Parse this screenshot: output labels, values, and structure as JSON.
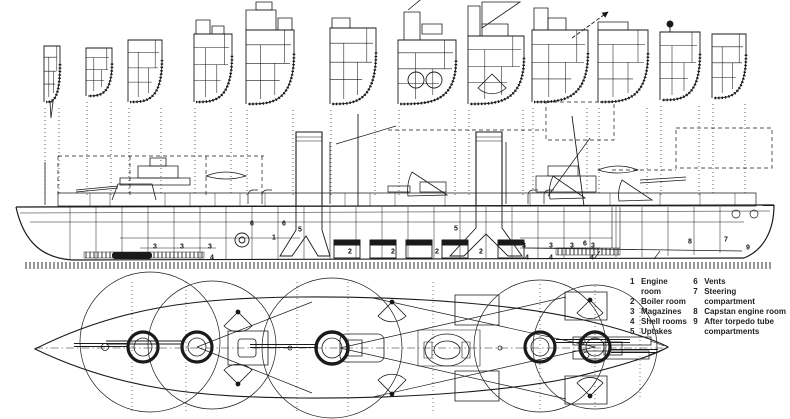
{
  "page": {
    "kind": "warship deck and profile plans (scanned line drawing)",
    "ink_color": "#1a1a1a",
    "paper_color": "#ffffff"
  },
  "views": {
    "cross_sections": {
      "name": "hull cross-sections",
      "count": 12
    },
    "profile": {
      "name": "side elevation with internal compartments"
    },
    "plan": {
      "name": "deck plan with gun arcs"
    }
  },
  "legend": {
    "columns": [
      {
        "items": [
          {
            "num": "1",
            "label": "Engine room"
          },
          {
            "num": "2",
            "label": "Boiler room"
          },
          {
            "num": "3",
            "label": "Magazines"
          },
          {
            "num": "4",
            "label": "Shell rooms"
          },
          {
            "num": "5",
            "label": "Uptakes"
          }
        ]
      },
      {
        "items": [
          {
            "num": "6",
            "label": "Vents"
          },
          {
            "num": "7",
            "label": "Steering compartment"
          },
          {
            "num": "8",
            "label": "Capstan engine room"
          },
          {
            "num": "9",
            "label": "After torpedo tube\ncompartments"
          }
        ]
      }
    ]
  },
  "profile_labels": [
    {
      "num": "3",
      "x": 155,
      "y": 247
    },
    {
      "num": "3",
      "x": 182,
      "y": 247
    },
    {
      "num": "3",
      "x": 210,
      "y": 247
    },
    {
      "num": "4",
      "x": 212,
      "y": 258
    },
    {
      "num": "6",
      "x": 252,
      "y": 224
    },
    {
      "num": "6",
      "x": 284,
      "y": 224
    },
    {
      "num": "1",
      "x": 274,
      "y": 238
    },
    {
      "num": "5",
      "x": 300,
      "y": 230
    },
    {
      "num": "2",
      "x": 350,
      "y": 252
    },
    {
      "num": "2",
      "x": 393,
      "y": 252
    },
    {
      "num": "2",
      "x": 437,
      "y": 252
    },
    {
      "num": "5",
      "x": 456,
      "y": 229
    },
    {
      "num": "2",
      "x": 481,
      "y": 252
    },
    {
      "num": "3",
      "x": 524,
      "y": 246
    },
    {
      "num": "3",
      "x": 551,
      "y": 246
    },
    {
      "num": "3",
      "x": 572,
      "y": 246
    },
    {
      "num": "3",
      "x": 593,
      "y": 246
    },
    {
      "num": "4",
      "x": 527,
      "y": 258
    },
    {
      "num": "4",
      "x": 551,
      "y": 258
    },
    {
      "num": "4",
      "x": 592,
      "y": 258
    },
    {
      "num": "6",
      "x": 585,
      "y": 244
    },
    {
      "num": "8",
      "x": 690,
      "y": 242
    },
    {
      "num": "7",
      "x": 726,
      "y": 240
    },
    {
      "num": "9",
      "x": 748,
      "y": 248
    }
  ]
}
